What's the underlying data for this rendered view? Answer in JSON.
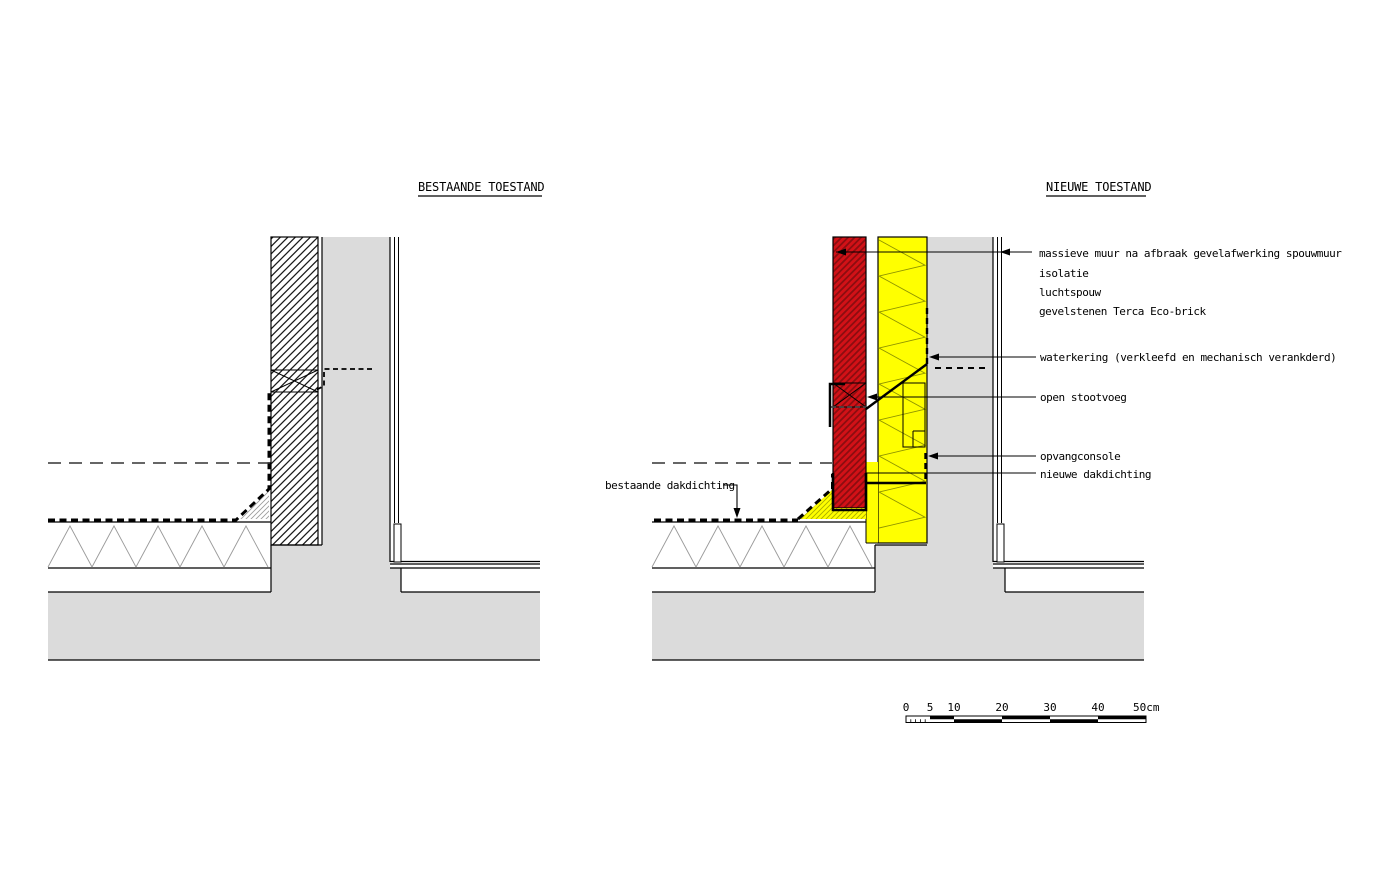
{
  "left_drawing": {
    "title": "BESTAANDE TOESTAND"
  },
  "right_drawing": {
    "title": "NIEUWE TOESTAND",
    "labels": {
      "layer1": "massieve muur na afbraak gevelafwerking spouwmuur",
      "layer2": "isolatie",
      "layer3": "luchtspouw",
      "layer4": "gevelstenen Terca Eco-brick",
      "waterkering": "waterkering (verkleefd en mechanisch verankderd)",
      "open_stootvoeg": "open stootvoeg",
      "opvangconsole": "opvangconsole",
      "nieuwe_dakdichting": "nieuwe dakdichting",
      "bestaande_dakdichting": "bestaande dakdichting"
    }
  },
  "scale_bar": {
    "tick_0": "0",
    "tick_5": "5",
    "tick_10": "10",
    "tick_20": "20",
    "tick_30": "30",
    "tick_40": "40",
    "end_label": "50cm"
  },
  "colors": {
    "concrete_grey": "#dbdbdb",
    "brick_red": "#d21117",
    "insulation_yellow": "#ffff00"
  }
}
